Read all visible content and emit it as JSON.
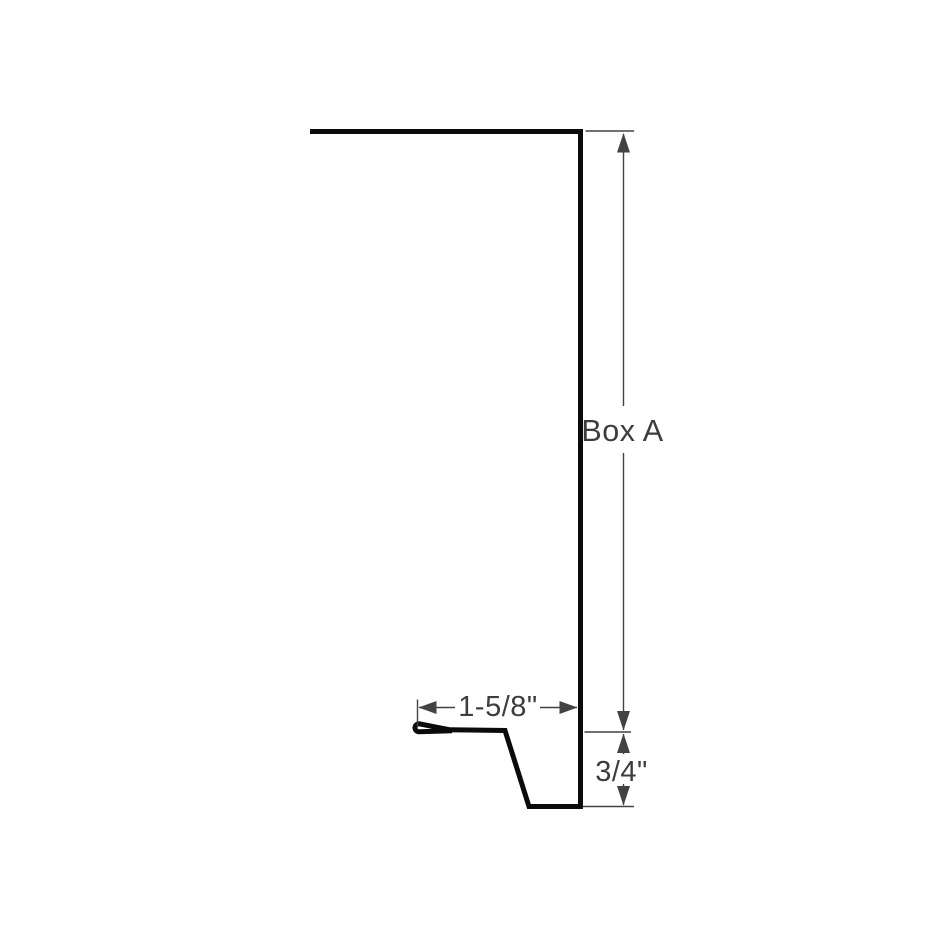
{
  "diagram": {
    "type": "metal-trim-profile-cross-section",
    "labels": {
      "vertical_dimension": "Box A",
      "flange_width_dimension": "1-5/8\"",
      "kick_height_dimension": "3/4\""
    },
    "colors": {
      "background": "#ffffff",
      "profile": "#0b0b0b",
      "dimension": "#424242",
      "text": "#3d3d3d"
    }
  }
}
